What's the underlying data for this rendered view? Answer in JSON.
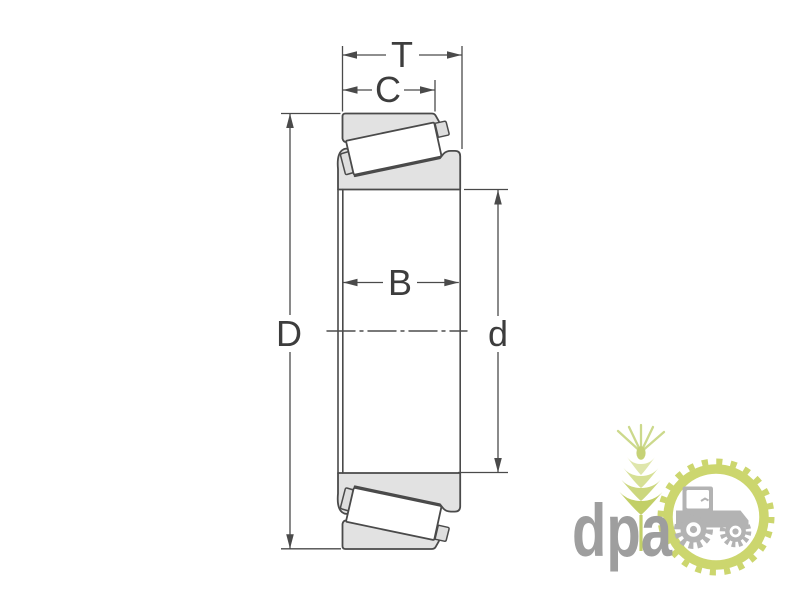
{
  "diagram": {
    "dimension_labels": {
      "T": "T",
      "C": "C",
      "B": "B",
      "D": "D",
      "d": "d"
    },
    "colors": {
      "outline": "#4a4a4a",
      "ring_fill": "#e2e2e2",
      "roller_fill": "#ffffff",
      "background": "#ffffff"
    }
  },
  "watermark": {
    "text": "dpa",
    "colors": {
      "text_gray": "#9e9e9e",
      "tractor_gray": "#b3b3b3",
      "green": "#ccd66e"
    },
    "icons": [
      "wheat-icon",
      "gear-ring-icon",
      "tractor-icon"
    ]
  }
}
